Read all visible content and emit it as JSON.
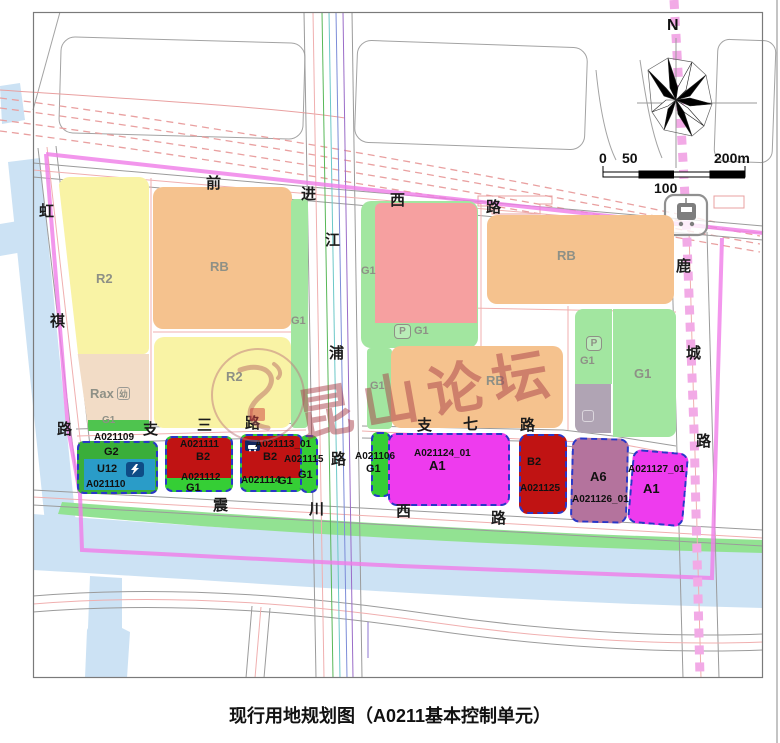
{
  "title": "现行用地规划图（A0211基本控制单元）",
  "watermark": {
    "text": "昆山论坛"
  },
  "compass": {
    "label": "N"
  },
  "scale_bar": {
    "zero": "0",
    "fifty": "50",
    "hundred": "100",
    "two_hundred": "200m"
  },
  "roads": {
    "qianjin_west": {
      "name": "前进西路",
      "chars": [
        "前",
        "进",
        "西",
        "路"
      ]
    },
    "jiangpu": {
      "name": "江浦路",
      "chars": [
        "江",
        "浦",
        "路"
      ]
    },
    "hongqi": {
      "name": "虹祺路",
      "chars": [
        "虹",
        "祺",
        "路"
      ]
    },
    "zhisan": {
      "name": "支三路",
      "chars": [
        "支",
        "三",
        "路"
      ]
    },
    "zhiqi": {
      "name": "支七路",
      "chars": [
        "支",
        "七",
        "路"
      ]
    },
    "zhenchuan_west": {
      "name": "震川西路",
      "chars": [
        "震",
        "川",
        "西",
        "路"
      ]
    },
    "lucheng": {
      "name": "鹿城路",
      "chars": [
        "鹿",
        "城",
        "路"
      ]
    }
  },
  "parcels": {
    "r2_nw": {
      "use": "R2"
    },
    "rb_nw": {
      "use": "RB"
    },
    "g1_west_strip": {
      "use": "G1"
    },
    "r2_sw": {
      "use": "R2"
    },
    "rax": {
      "use": "Rax",
      "icon": "幼",
      "strip_use": "G1"
    },
    "g1_mid_wrap": {
      "use": "G1",
      "p_label": "P",
      "p_use": "G1"
    },
    "rb_ne": {
      "use": "RB"
    },
    "rb_mid": {
      "use": "RB",
      "strip_use": "G1"
    },
    "g1_p_east": {
      "use": "G1",
      "p_label": "P"
    },
    "g1_east": {
      "use": "G1"
    },
    "a021109": {
      "code": "A021109",
      "use": "G2"
    },
    "a021110": {
      "code": "A021110",
      "use": "U12"
    },
    "a021111": {
      "code": "A021111",
      "use": "B2"
    },
    "a021112": {
      "code": "A021112",
      "use": "G1"
    },
    "a021113": {
      "code": "A021113_01",
      "use": "B2"
    },
    "a021114": {
      "code": "A021114",
      "use": "G1"
    },
    "a021115": {
      "code": "A021115",
      "use": "G1"
    },
    "a021106": {
      "code": "A021106",
      "use": "G1"
    },
    "a021124": {
      "code": "A021124_01",
      "use": "A1"
    },
    "a021125": {
      "code": "A021125",
      "use": "B2"
    },
    "a021126": {
      "code": "A021126_01",
      "use": "A6"
    },
    "a021127": {
      "code": "A021127_01",
      "use": "A1"
    }
  },
  "colors": {
    "residential_r2": "#F9F3A5",
    "residential_commercial_rb": "#F5C28E",
    "rax": "#F2DCC6",
    "salmon_parcel": "#F6A0A0",
    "green_g1": "#A2E6A0",
    "green_strip": "#35CE35",
    "green_g2": "#3AAE3A",
    "utility_u12": "#2A9CC8",
    "commercial_b2": "#C01313",
    "admin_a1": "#EE3BEE",
    "a6_mauve": "#B4739D",
    "gray_mauve": "#B0A4B4",
    "water": "#CCE2F4",
    "river_bank": "#92E292",
    "boundary_magenta": "#F07DE8",
    "metro_line_pink": "#F2AAE6",
    "unit_dashed_border": "#2937C8"
  }
}
